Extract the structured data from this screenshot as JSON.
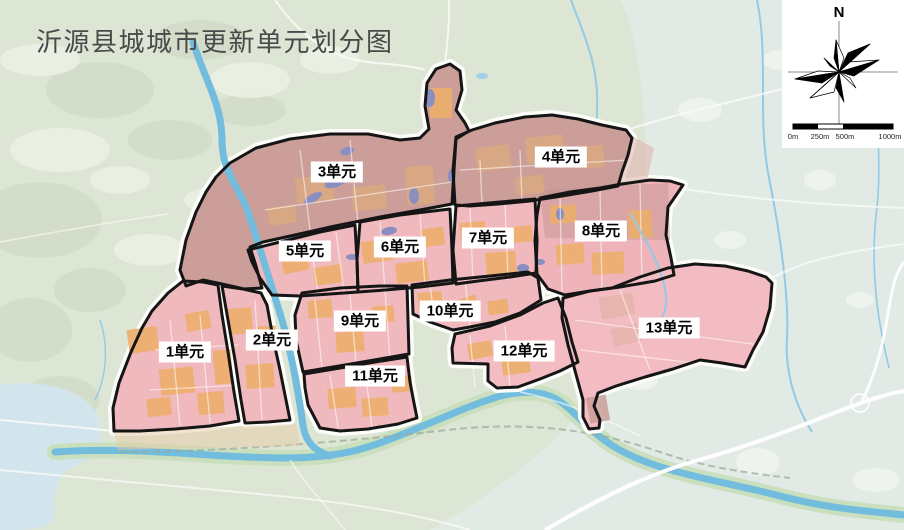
{
  "title": "沂源县城城市更新单元划分图",
  "map": {
    "units": [
      {
        "id": "u1",
        "label": "1单元",
        "x": 185,
        "y": 352,
        "tone": "pink"
      },
      {
        "id": "u2",
        "label": "2单元",
        "x": 272,
        "y": 340,
        "tone": "pink"
      },
      {
        "id": "u3",
        "label": "3单元",
        "x": 337,
        "y": 172,
        "tone": "mauve"
      },
      {
        "id": "u4",
        "label": "4单元",
        "x": 561,
        "y": 157,
        "tone": "mauve"
      },
      {
        "id": "u5",
        "label": "5单元",
        "x": 305,
        "y": 251,
        "tone": "pink"
      },
      {
        "id": "u6",
        "label": "6单元",
        "x": 400,
        "y": 247,
        "tone": "pink"
      },
      {
        "id": "u7",
        "label": "7单元",
        "x": 488,
        "y": 238,
        "tone": "pink"
      },
      {
        "id": "u8",
        "label": "8单元",
        "x": 601,
        "y": 231,
        "tone": "pink8"
      },
      {
        "id": "u9",
        "label": "9单元",
        "x": 360,
        "y": 321,
        "tone": "pink"
      },
      {
        "id": "u10",
        "label": "10单元",
        "x": 450,
        "y": 311,
        "tone": "pink"
      },
      {
        "id": "u11",
        "label": "11单元",
        "x": 375,
        "y": 376,
        "tone": "pink"
      },
      {
        "id": "u12",
        "label": "12单元",
        "x": 524,
        "y": 351,
        "tone": "light"
      },
      {
        "id": "u13",
        "label": "13单元",
        "x": 669,
        "y": 328,
        "tone": "light"
      }
    ],
    "colors": {
      "pink": "#f0b9be",
      "pink8": "#eeb4ba",
      "light": "#f3bcc3",
      "mauve": "#cb9e99",
      "boundary": "#151515",
      "road_white": "#fcfcf9",
      "river": "#72bcde",
      "river_bank": "#c9dfbe",
      "terrain_left": "#dde6d5",
      "terrain_right": "#e2eae5",
      "pond": "#8a8ec0",
      "block_orange": "#ecae6c"
    }
  },
  "compass": {
    "north_label": "N"
  },
  "scalebar": {
    "labels": [
      "0m",
      "250m",
      "500m",
      "1000m"
    ]
  }
}
